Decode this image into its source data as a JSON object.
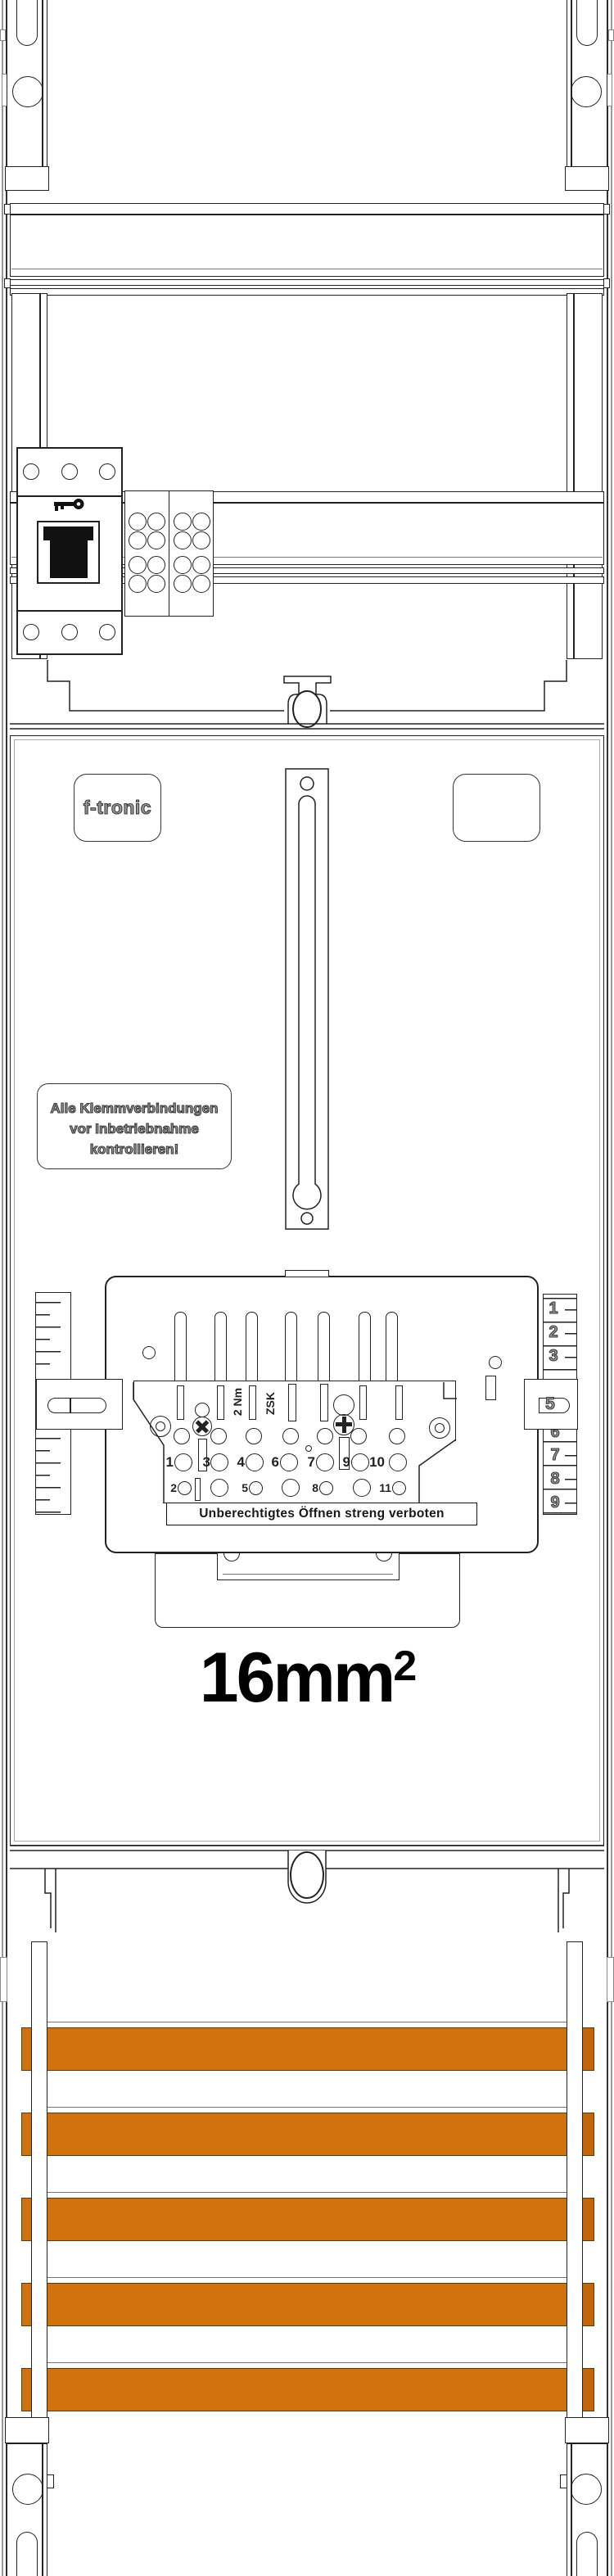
{
  "brand": {
    "logo": "f-tronic"
  },
  "panel": {
    "warning_line1": "Alle Klemmverbindungen",
    "warning_line2": "vor Inbetriebnahme",
    "warning_line3": "kontrollieren!",
    "size_label": "16mm",
    "size_superscript": "2"
  },
  "terminal_block": {
    "torque_label": "2 Nm",
    "type_label": "ZSK",
    "prohibition_label": "Unberechtigtes Öffnen streng verboten",
    "row_main_numbers": [
      "1",
      "3",
      "4",
      "6",
      "7",
      "9",
      "10"
    ],
    "row_lower_numbers": [
      "2",
      "5",
      "8",
      "11"
    ],
    "scale_numbers_top": [
      "1",
      "2",
      "3"
    ],
    "scale_latch_number": "5",
    "scale_numbers_bottom": [
      "6",
      "7",
      "8",
      "9"
    ]
  },
  "colors": {
    "busbar_orange": "#d2720e",
    "busbar_end": "#c2660b",
    "line_dark": "#222222"
  }
}
